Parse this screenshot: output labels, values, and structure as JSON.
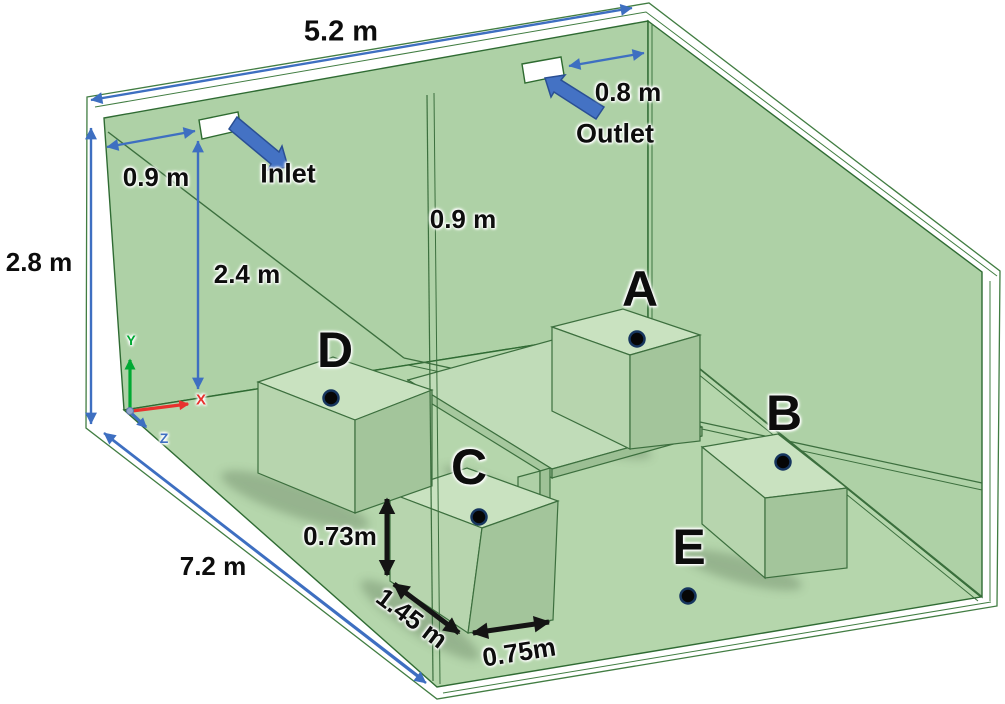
{
  "figure": {
    "title": "Ventilated room geometry with measurement points",
    "room": {
      "width_label": "5.2 m",
      "height_label": "2.8 m",
      "depth_label": "7.2 m"
    },
    "vents": {
      "inlet_label": "Inlet",
      "outlet_label": "Outlet",
      "inlet_offset_label": "0.9 m",
      "inlet_height_label": "2.4 m",
      "outlet_offset_label": "0.8 m",
      "back_wall_offset_label": "0.9 m"
    },
    "obstacle_dimensions": {
      "height_label": "0.73m",
      "length_label": "1.45 m",
      "width_label": "0.75m"
    },
    "points": {
      "a": "A",
      "b": "B",
      "c": "C",
      "d": "D",
      "e": "E"
    },
    "axes": {
      "x": "X",
      "y": "Y",
      "z": "Z"
    }
  },
  "colors": {
    "arrow_blue": "#4472c4",
    "arrow_blue_dark": "#2a4f94",
    "dimension_black": "#141414",
    "back_wall_green": "#aed1a6",
    "right_wall_green": "#a8cd9f",
    "floor_green": "#b5d6ac",
    "edge_green": "#2f6b33",
    "axis_x_red": "#e8322e",
    "axis_y_green": "#00a933",
    "axis_z_blue": "#4472c4",
    "vent_white": "#ffffff",
    "point_dot_black": "#060606",
    "point_dot_ring_blue": "#16355e"
  }
}
